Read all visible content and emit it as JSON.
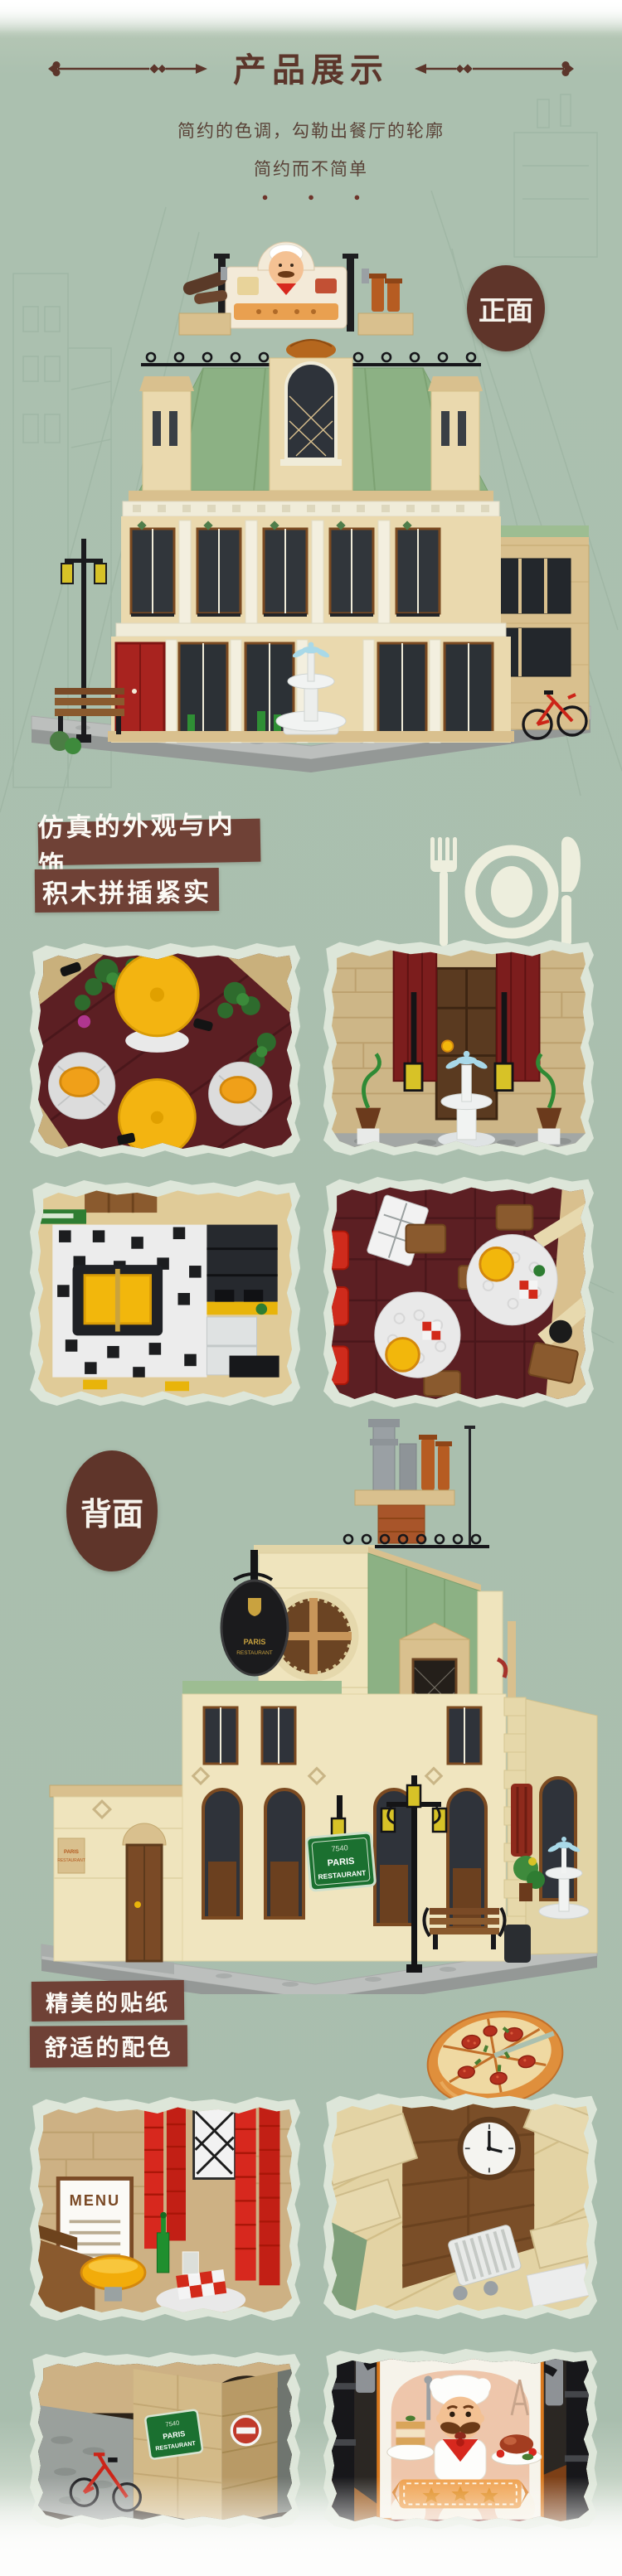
{
  "theme": {
    "background_green": "#abc0af",
    "title_brown": "#5c362b",
    "subtitle_brown": "#5a4338",
    "feature_box_brown": "#6f4136",
    "badge_brown": "#5f352a",
    "torn_paper": "#dde6d9",
    "lego_tan": "#e9ddae",
    "lego_roof_green": "#8cb184",
    "lego_dark_red": "#5c1f23",
    "lego_yellow": "#f2b70c",
    "lego_red": "#d7281e",
    "baseplate_gray": "#bcbfbd"
  },
  "header": {
    "title": "产品展示",
    "subtitle_line1": "简约的色调，勾勒出餐厅的轮廓",
    "subtitle_line2": "简约而不简单",
    "dots": "●  ●  ●"
  },
  "sections": {
    "front_badge": "正面",
    "back_badge": "背面",
    "feature1_line1": "仿真的外观与内饰",
    "feature1_line2": "积木拼插紧实",
    "feature2_line1": "精美的贴纸",
    "feature2_line2": "舒适的配色"
  },
  "signs": {
    "menu": "MENU",
    "street_number": "7540",
    "street_line1": "PARIS",
    "street_line2": "RESTAURANT",
    "oval_line1": "PARIS",
    "oval_line2": "RESTAURANT",
    "annex_line1": "PARIS",
    "annex_line2": "RESTAURANT"
  },
  "gallery1": [
    {
      "id": "rooftop-terrace-photo"
    },
    {
      "id": "entrance-fountain-photo"
    },
    {
      "id": "kitchen-interior-photo"
    },
    {
      "id": "dining-room-photo"
    }
  ],
  "gallery2": [
    {
      "id": "menu-corner-photo"
    },
    {
      "id": "clock-wall-photo"
    },
    {
      "id": "street-corner-bicycle-photo"
    },
    {
      "id": "chef-signboard-photo"
    }
  ]
}
